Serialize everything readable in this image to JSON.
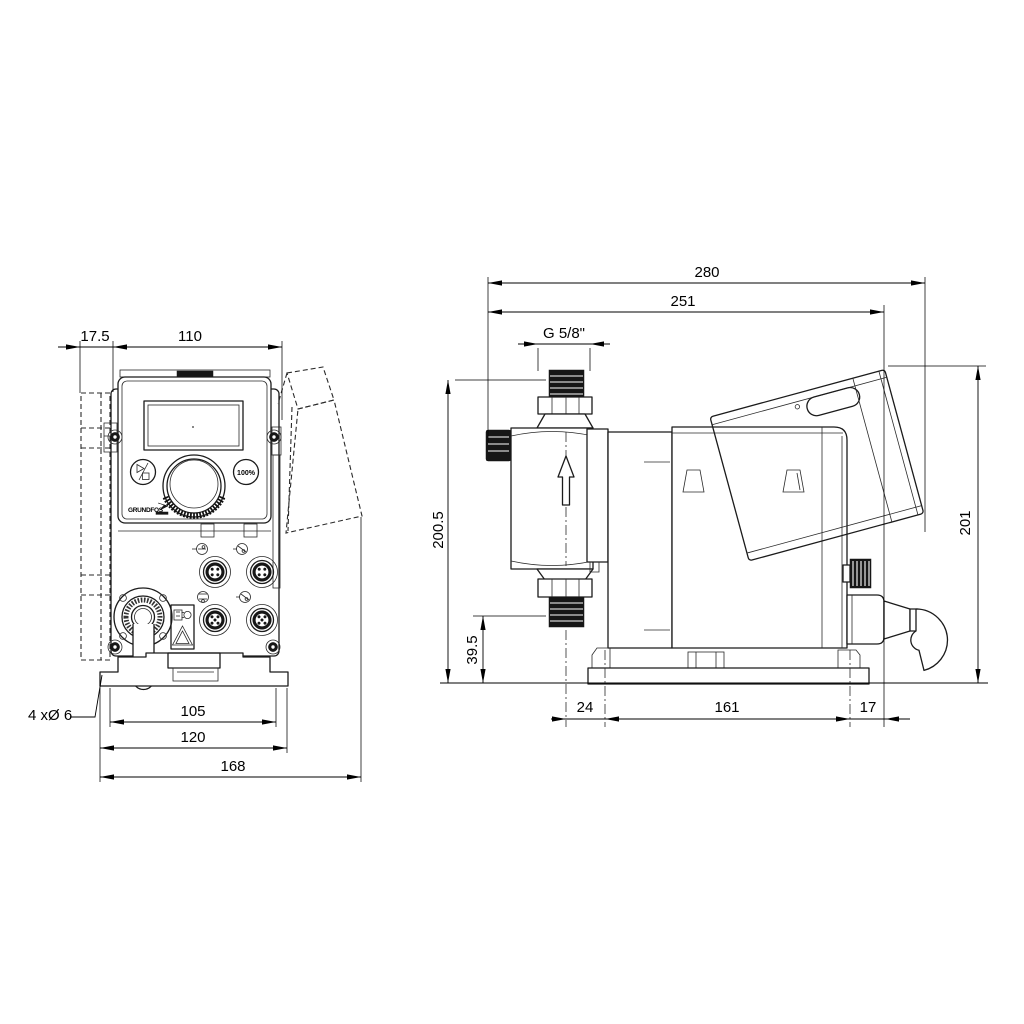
{
  "front_view": {
    "dims": {
      "offset": "17.5",
      "width": "110",
      "hole_spacing": "105",
      "plate_width": "120",
      "total_width": "168",
      "holes": "4 xØ 6"
    },
    "panel": {
      "capacity_button": "100%",
      "logo": "GRUNDFOS"
    }
  },
  "side_view": {
    "dims": {
      "total_depth": "280",
      "body_depth": "251",
      "thread": "G 5/8\"",
      "height": "200.5",
      "suction_height": "39.5",
      "front_offset": "24",
      "hole_spacing": "161",
      "rear_offset": "17",
      "cover_height": "201"
    }
  }
}
